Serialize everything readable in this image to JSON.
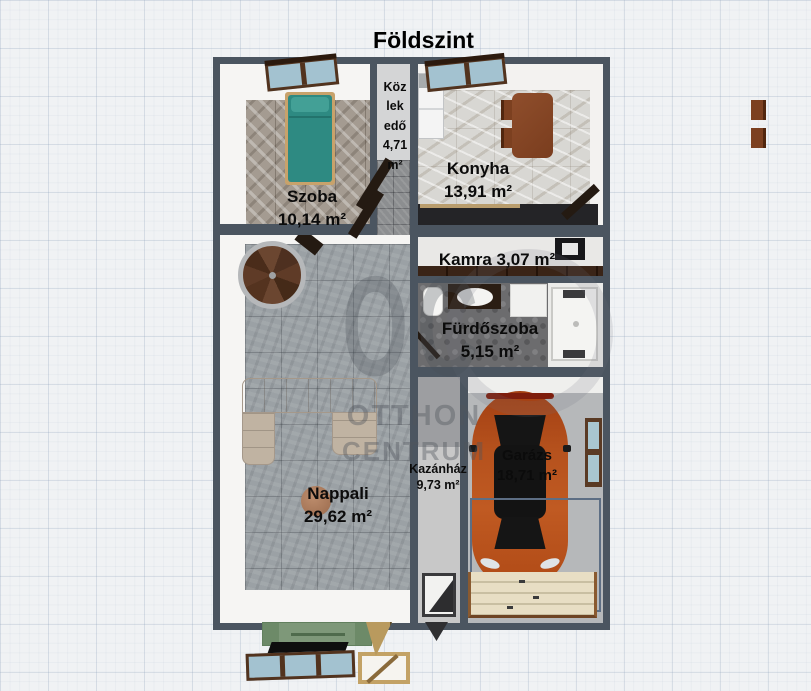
{
  "title": "Földszint",
  "watermark": {
    "monogram": "OC",
    "line1": "OTTHON",
    "line2": "CENTRUM"
  },
  "rooms": {
    "szoba": {
      "name": "Szoba",
      "area": "10,14 m²"
    },
    "kozlekedo": {
      "lines": [
        "Köz",
        "lek",
        "edő",
        "4,71",
        "m²"
      ]
    },
    "konyha": {
      "name": "Konyha",
      "area": "13,91 m²"
    },
    "kamra": {
      "label": "Kamra 3,07 m²"
    },
    "furdoszoba": {
      "name": "Fürdőszoba",
      "area": "5,15 m²"
    },
    "nappali": {
      "name": "Nappali",
      "area": "29,62 m²"
    },
    "kazanhaz": {
      "name": "Kazánház",
      "area": "9,73 m²"
    },
    "garazs": {
      "name": "Garázs",
      "area": "18,71 m²"
    }
  },
  "colors": {
    "wall": "#4b5560",
    "bed": "#2e8a82",
    "car": "#b04e1b",
    "tv_cabinet": "#7e9879",
    "garage_door": "#e8dec4"
  }
}
